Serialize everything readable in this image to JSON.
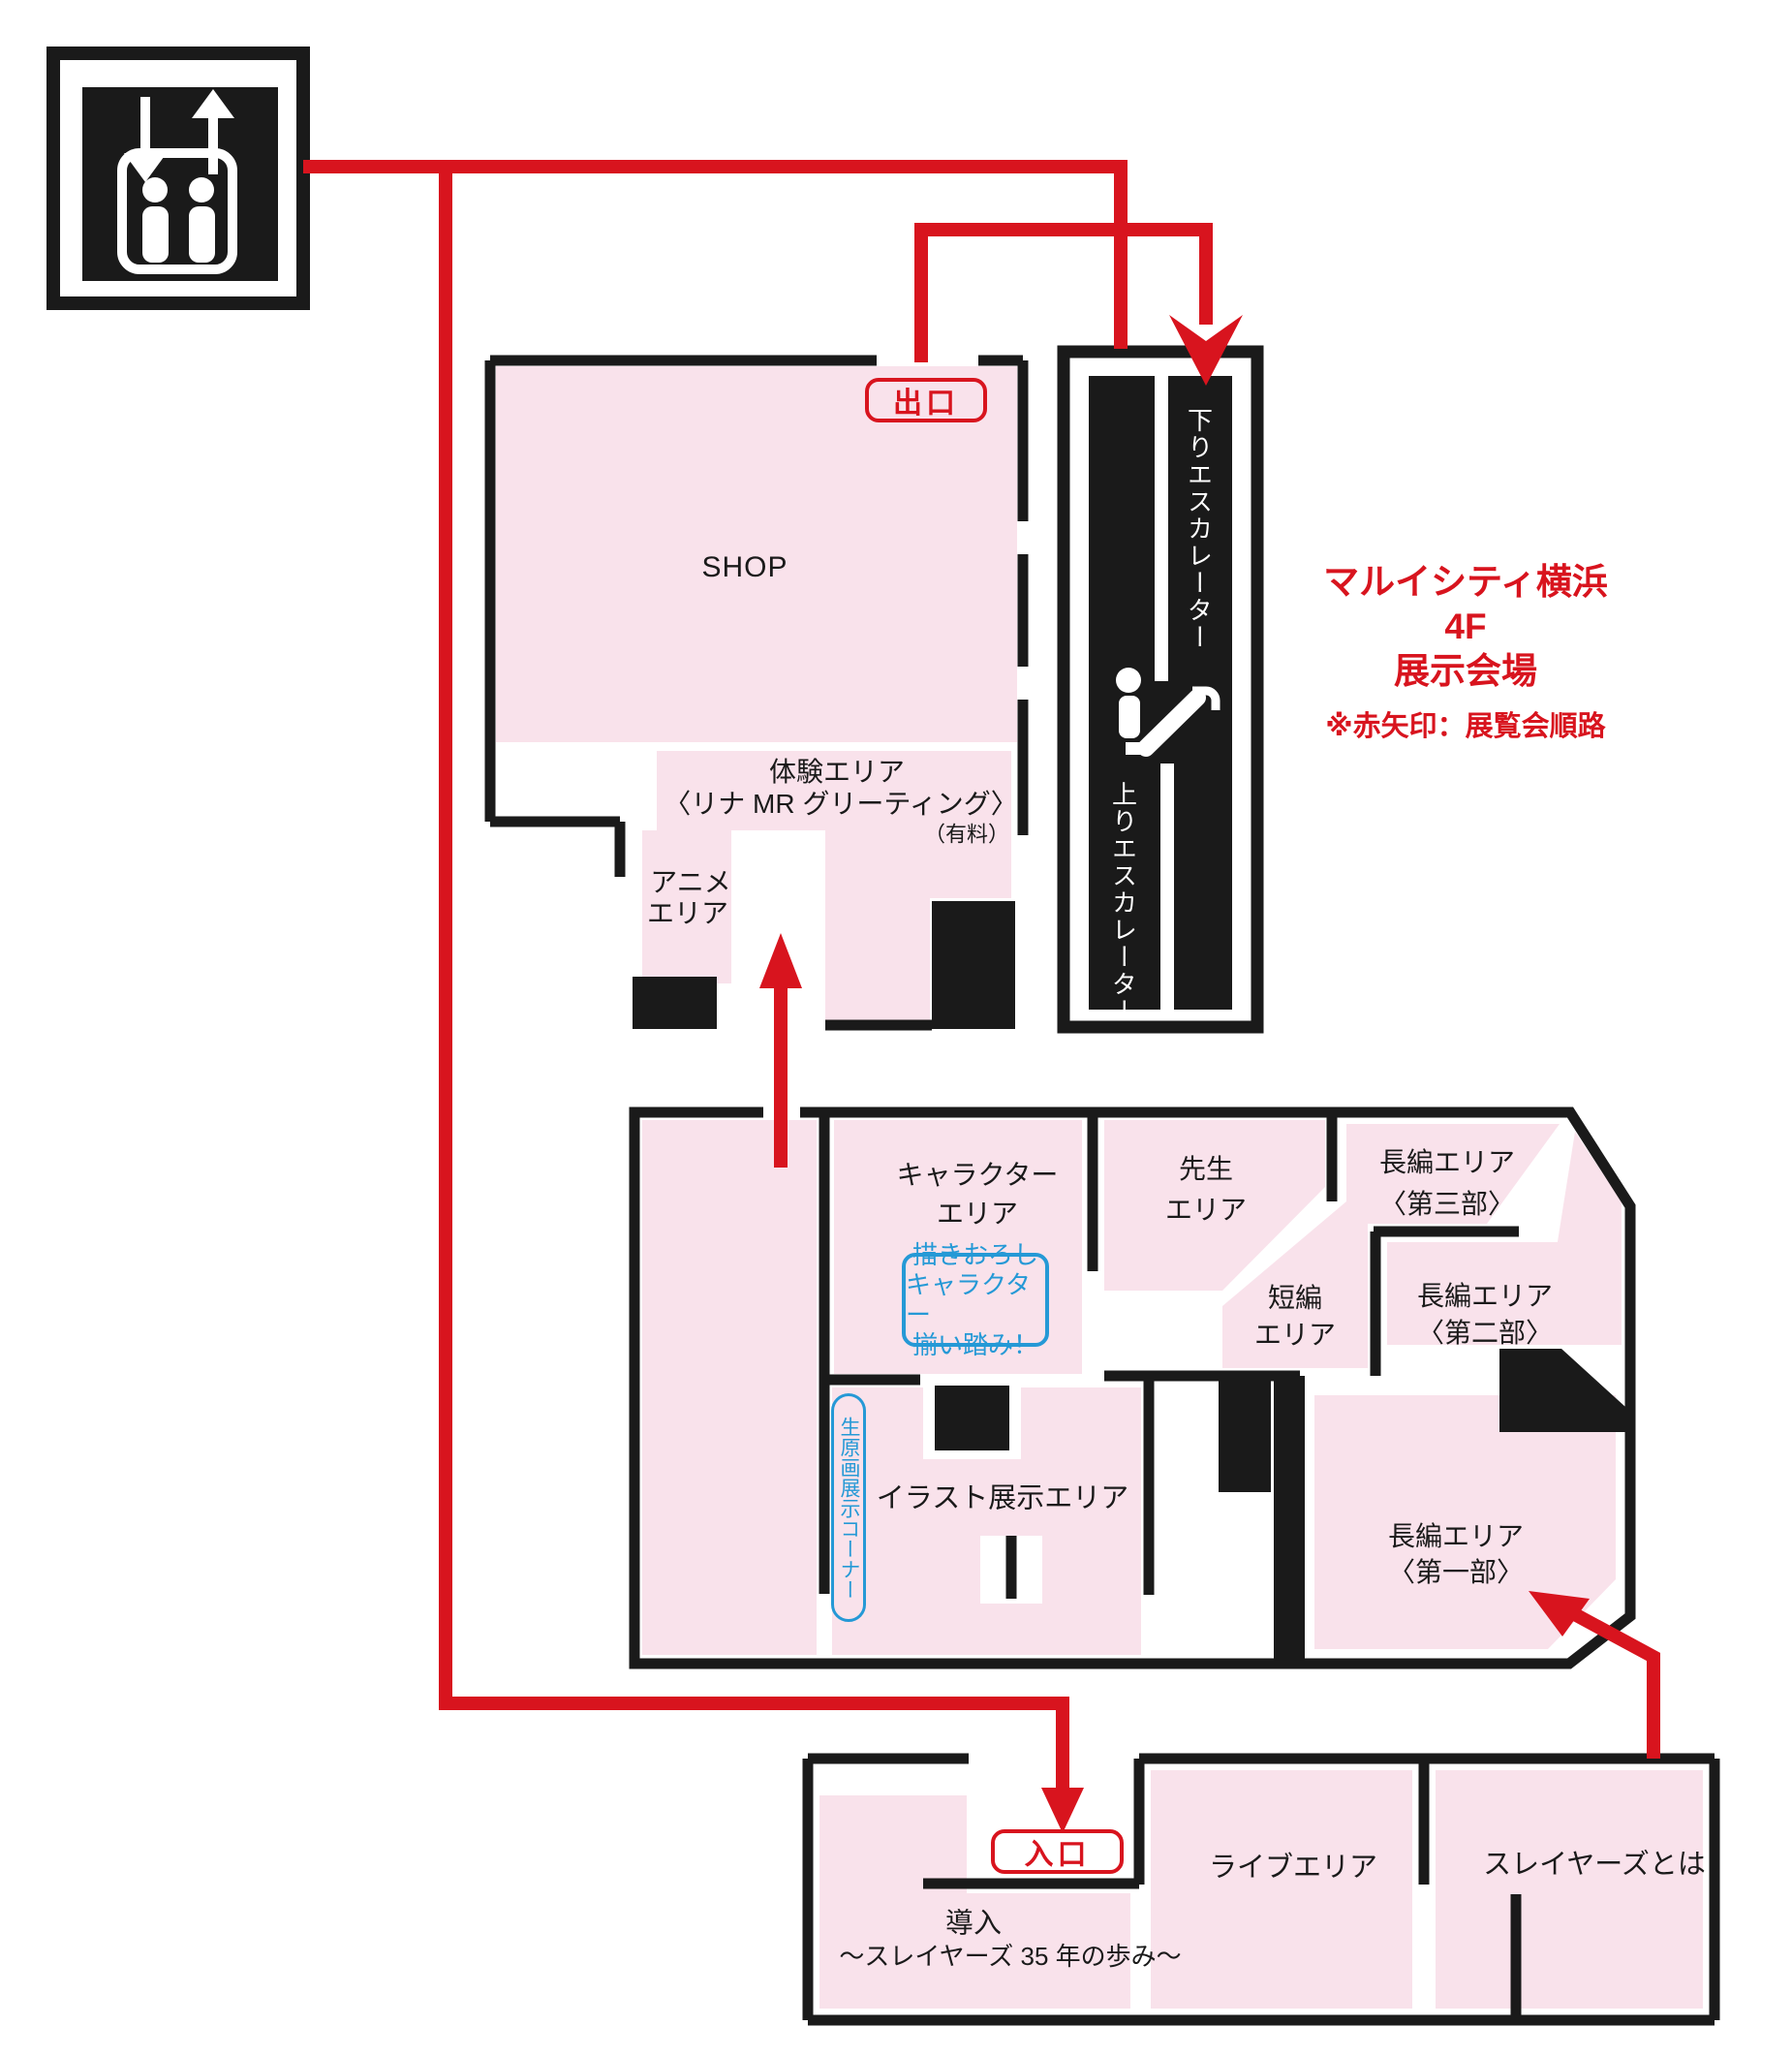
{
  "map_title": {
    "line1": "マルイシティ横浜 4F",
    "line2": "展示会場",
    "note": "※赤矢印：展覧会順路"
  },
  "colors": {
    "area_pink": "#f9e2eb",
    "wall_black": "#1a1a1a",
    "route_red": "#d8141e",
    "accent_blue": "#2599d6"
  },
  "areas": {
    "shop": "SHOP",
    "taiken": {
      "line1": "体験エリア",
      "line2": "〈リナ MR グリーティング〉",
      "fee": "（有料）"
    },
    "anime": {
      "line1": "アニメ",
      "line2": "エリア"
    },
    "character": {
      "line1": "キャラクター",
      "line2": "エリア"
    },
    "sensei": {
      "line1": "先生",
      "line2": "エリア"
    },
    "chohen3": {
      "line1": "長編エリア",
      "line2": "〈第三部〉"
    },
    "tanpen": {
      "line1": "短編",
      "line2": "エリア"
    },
    "chohen2": {
      "line1": "長編エリア",
      "line2": "〈第二部〉"
    },
    "illust": "イラスト展示エリア",
    "chohen1": {
      "line1": "長編エリア",
      "line2": "〈第一部〉"
    },
    "donyu": {
      "line1": "導入",
      "line2": "～スレイヤーズ 35 年の歩み～"
    },
    "live": "ライブエリア",
    "slayers": "スレイヤーズとは"
  },
  "badges": {
    "exit": "出口",
    "entrance": "入口",
    "draw": {
      "line1": "描きおろし",
      "line2": "キャラクター",
      "line3": "揃い踏み！"
    },
    "genga": "生原画展示コーナー"
  },
  "escalator": {
    "down": "下りエスカレーター",
    "up": "上りエスカレーター"
  }
}
